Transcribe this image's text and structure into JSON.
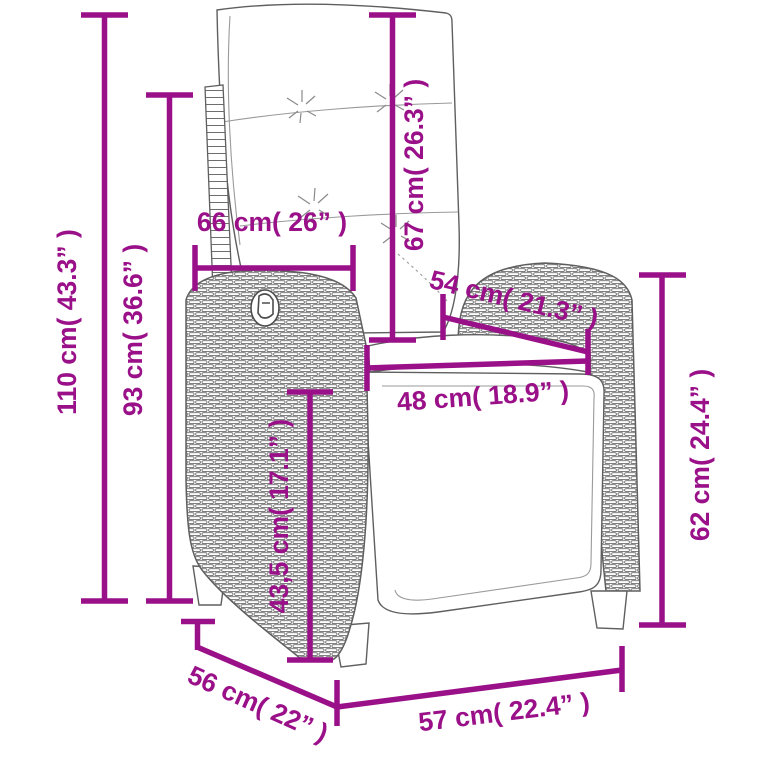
{
  "page": {
    "kind": "product-dimension-diagram",
    "subject": "reclining rattan garden chair with cushions",
    "background_color": "#ffffff"
  },
  "style": {
    "accent_color": "#9A1088",
    "outline_color": "#5f5f5f"
  },
  "dimensions": {
    "total_height": {
      "value_cm": "110",
      "value_in": "43.3",
      "label": "110 cm( 43.3” )"
    },
    "backrest_height": {
      "value_cm": "93",
      "value_in": "36.6",
      "label": "93 cm( 36.6” )"
    },
    "back_width": {
      "value_cm": "66",
      "value_in": "26",
      "label": "66 cm( 26” )"
    },
    "backrest_length": {
      "value_cm": "67",
      "value_in": "26.3",
      "label": "67 cm( 26.3” )"
    },
    "seat_depth_diagonal": {
      "value_cm": "54",
      "value_in": "21.3",
      "label": "54 cm( 21.3” )"
    },
    "seat_width": {
      "value_cm": "48",
      "value_in": "18.9",
      "label": "48 cm( 18.9” )"
    },
    "seat_height": {
      "value_cm": "43,5",
      "value_in": "17.1",
      "label": "43,5 cm( 17.1” )"
    },
    "armrest_height": {
      "value_cm": "62",
      "value_in": "24.4",
      "label": "62 cm( 24.4” )"
    },
    "base_depth": {
      "value_cm": "56",
      "value_in": "22",
      "label": "56 cm( 22” )"
    },
    "base_width": {
      "value_cm": "57",
      "value_in": "22.4",
      "label": "57 cm( 22.4” )"
    }
  }
}
